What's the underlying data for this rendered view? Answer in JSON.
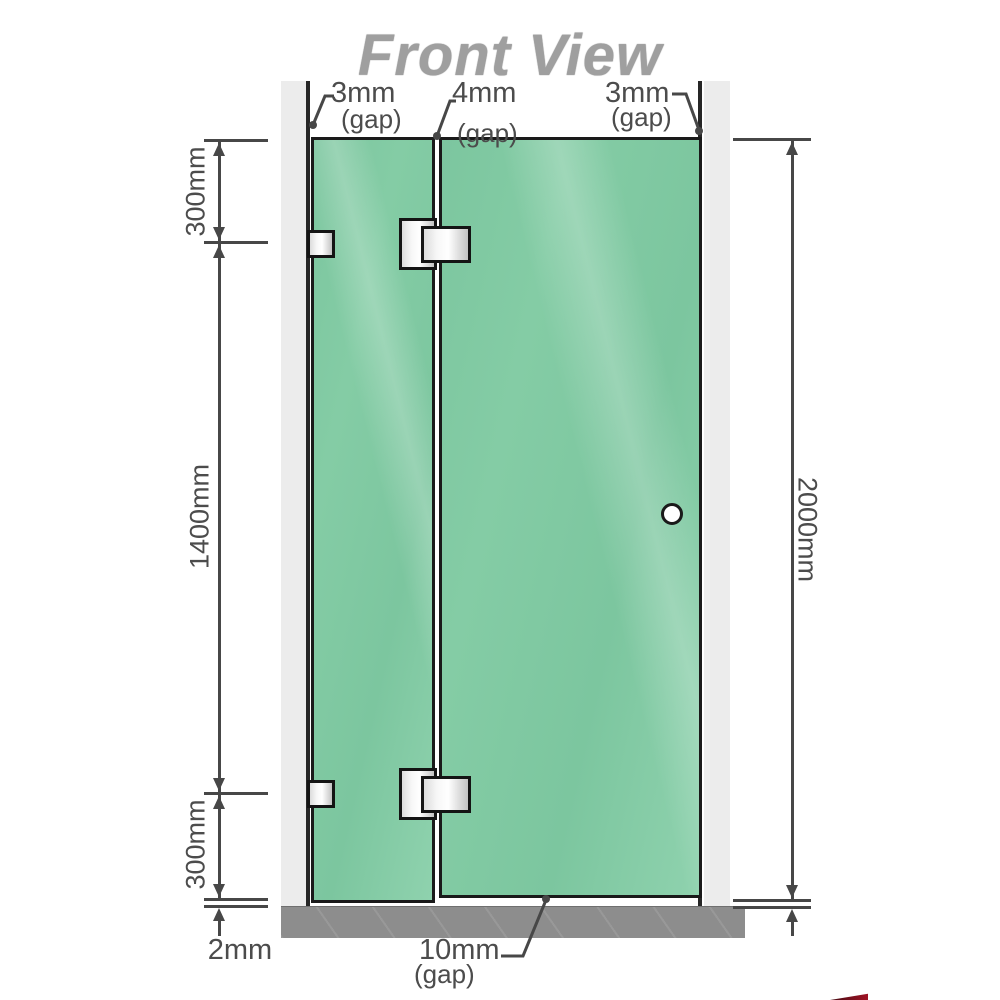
{
  "title": "Front View",
  "annotations": {
    "gap_top_left": {
      "value": "3mm",
      "suffix": "(gap)"
    },
    "gap_top_middle": {
      "value": "4mm",
      "suffix": "(gap)"
    },
    "gap_top_right": {
      "value": "3mm",
      "suffix": "(gap)"
    },
    "gap_bottom": {
      "value": "10mm",
      "suffix": "(gap)"
    },
    "dim_top_left": "300mm",
    "dim_middle_left": "1400mm",
    "dim_bottom_left": "300mm",
    "dim_right_height": "2000mm",
    "dim_floor_gap": "2mm"
  },
  "colors": {
    "glass_green": "#7cc69f",
    "glass_highlight": "#8fd2ae",
    "wall_channel": "#ececec",
    "floor_gray": "#8d8d8d",
    "dimension_line": "#474747",
    "title_gray": "#9f9f9f",
    "watermark_red": "#a01325"
  },
  "icons": {
    "door_handle": "circle-knob"
  }
}
